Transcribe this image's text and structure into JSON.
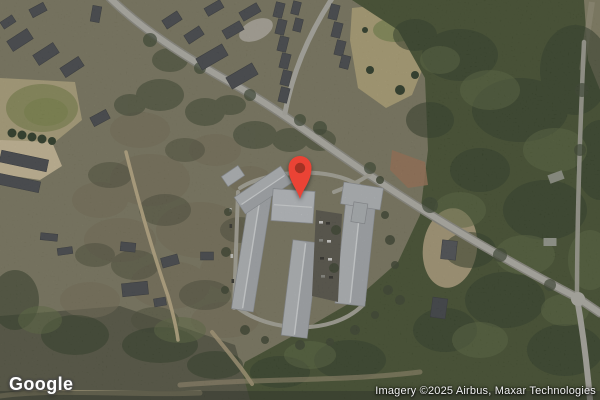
{
  "map": {
    "logo_text": "Google",
    "attribution": "Imagery ©2025 Airbus, Maxar Technologies",
    "pin": {
      "icon": "map-pin-icon",
      "color": "#EA4335",
      "dot_color": "#A33224"
    },
    "colors": {
      "forest_green": "#43502f",
      "scrub_base": "#7d7a61",
      "road_gray": "#b6b5ad",
      "apartment_roof": "#b8bcc0",
      "house_roof": "#45484d",
      "field_tan": "#b2a478"
    }
  }
}
